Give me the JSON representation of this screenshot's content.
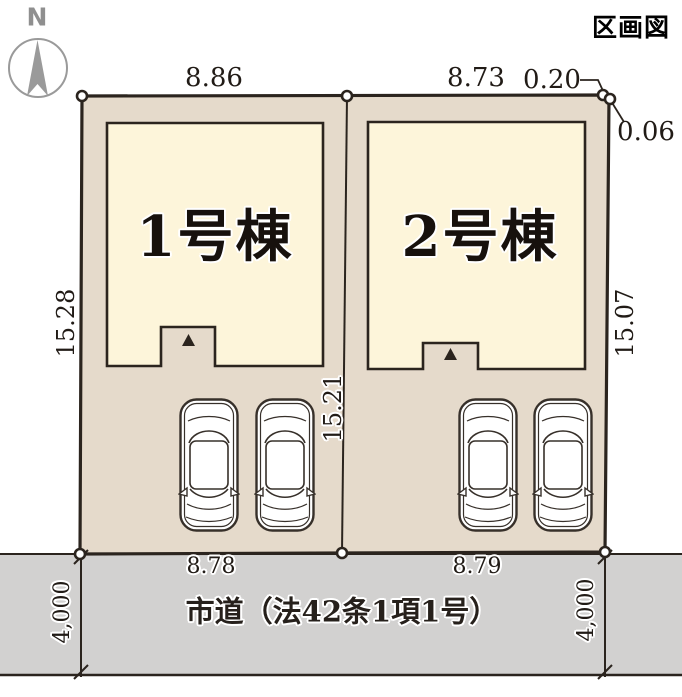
{
  "title": "区画図",
  "compass": {
    "north_label": "N"
  },
  "buildings": [
    {
      "label": "1号棟"
    },
    {
      "label": "2号棟"
    }
  ],
  "dimensions": {
    "plot1_top": "8.86",
    "plot2_top": "8.73",
    "corner_offset_h": "0.20",
    "corner_offset_v": "0.06",
    "plot1_left": "15.28",
    "plot1_right": "15.21",
    "plot2_right": "15.07",
    "plot1_frontage": "8.78",
    "plot2_frontage": "8.79"
  },
  "road": {
    "label": "市道（法42条1項1号）",
    "width_left": "4,000",
    "width_right": "4,000"
  },
  "colors": {
    "plot_fill": "#e5dacb",
    "building_fill": "#fdf5da",
    "road_fill": "#d2d1d0",
    "outline": "#2b241e",
    "triangle": "#2b241e",
    "compass_gray": "#9a9a9a",
    "car_stroke": "#37302a"
  }
}
